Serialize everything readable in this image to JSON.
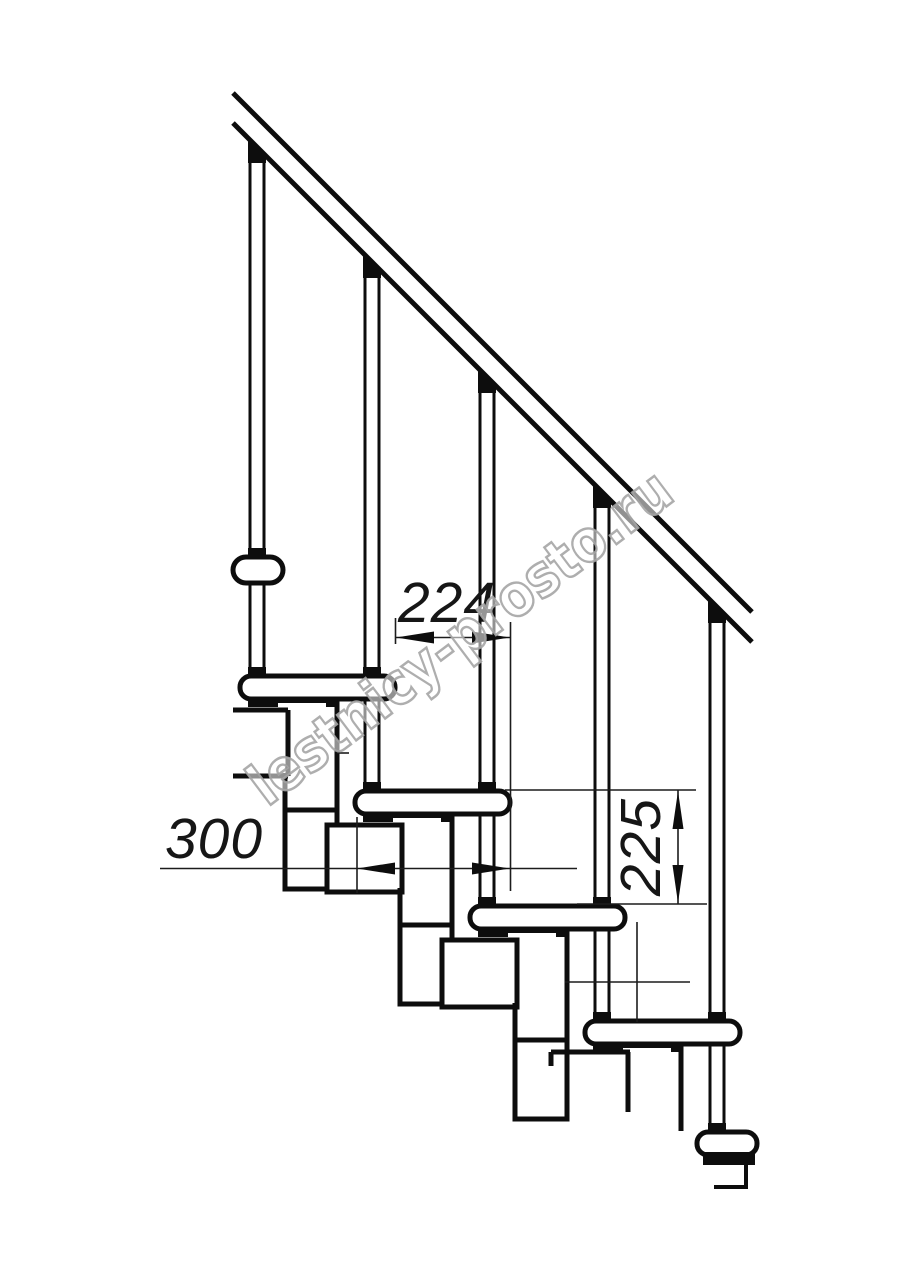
{
  "drawing": {
    "title": "modular staircase side elevation",
    "type": "technical-drawing"
  },
  "dimensions": {
    "tread_pitch": "224",
    "tread_depth": "300",
    "riser_height": "225"
  },
  "watermark": {
    "text": "lestnicy-prosto.ru"
  },
  "colors": {
    "line": "#0d0d0d",
    "thin_line": "#1c1c1c",
    "watermark_stroke": "#a5a5a5",
    "background": "#ffffff"
  }
}
